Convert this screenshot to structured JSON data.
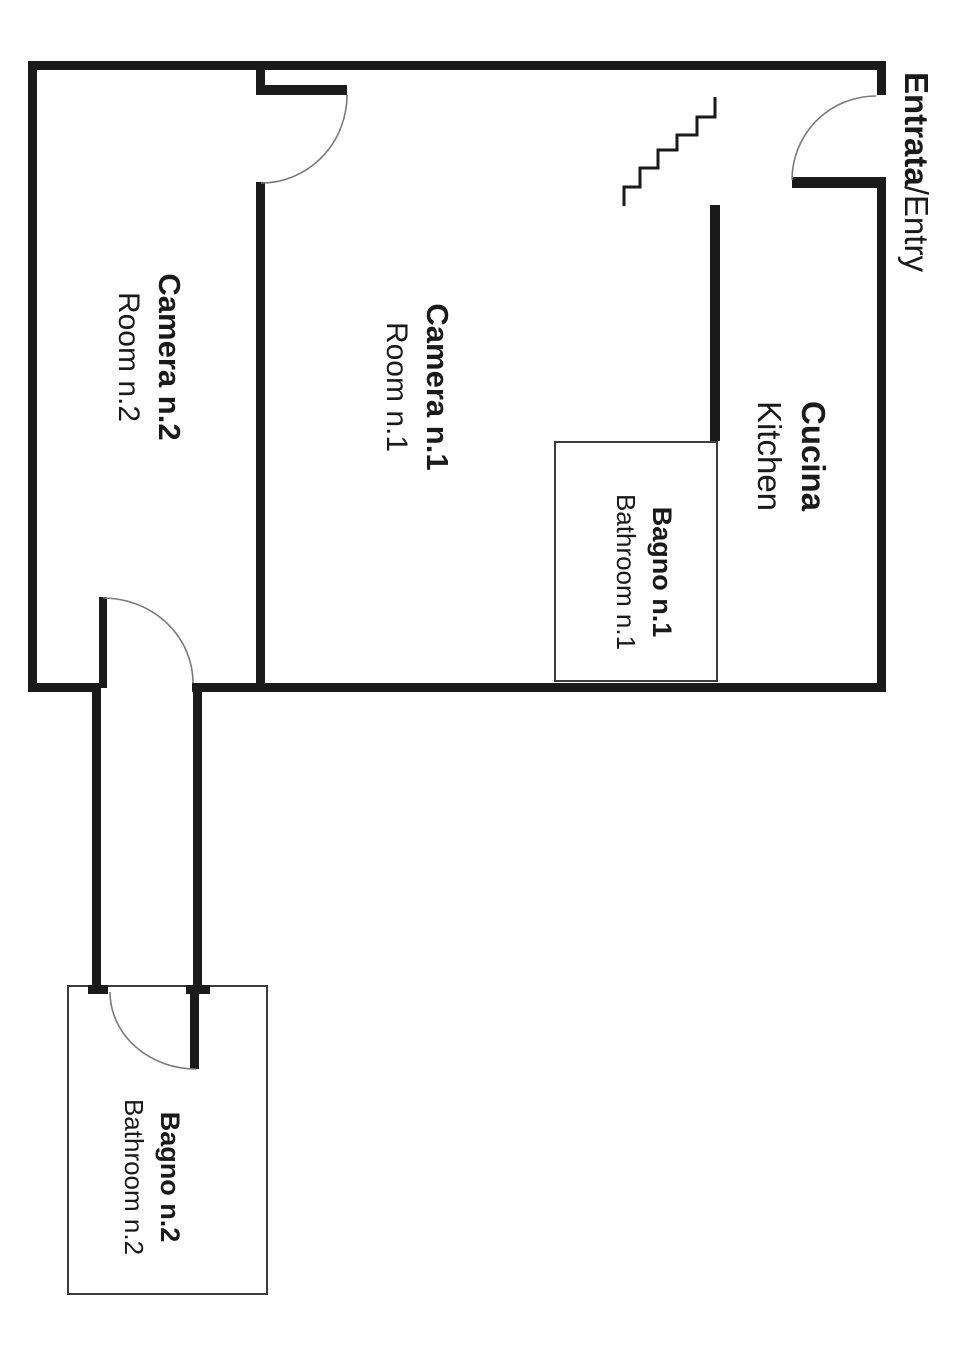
{
  "theme": {
    "background": "#ffffff",
    "wall_color": "#1a1a1a",
    "thin_line_color": "#3c3c3c",
    "door_arc_color": "#7a7a7a",
    "text_color": "#1a1a1a"
  },
  "entry": {
    "label_it": "Entrata",
    "separator": "/",
    "label_en": "Entry"
  },
  "rooms": {
    "camera2": {
      "label_it": "Camera n.2",
      "label_en": "Room n.2"
    },
    "camera1": {
      "label_it": "Camera n.1",
      "label_en": "Room n.1"
    },
    "cucina": {
      "label_it": "Cucina",
      "label_en": "Kitchen"
    },
    "bagno1": {
      "label_it": "Bagno n.1",
      "label_en": "Bathroom n.1"
    },
    "bagno2": {
      "label_it": "Bagno n.2",
      "label_en": "Bathroom n.2"
    }
  },
  "icons": {
    "stairs": "stairs-icon",
    "door_arcs": "door-swing-arc"
  }
}
